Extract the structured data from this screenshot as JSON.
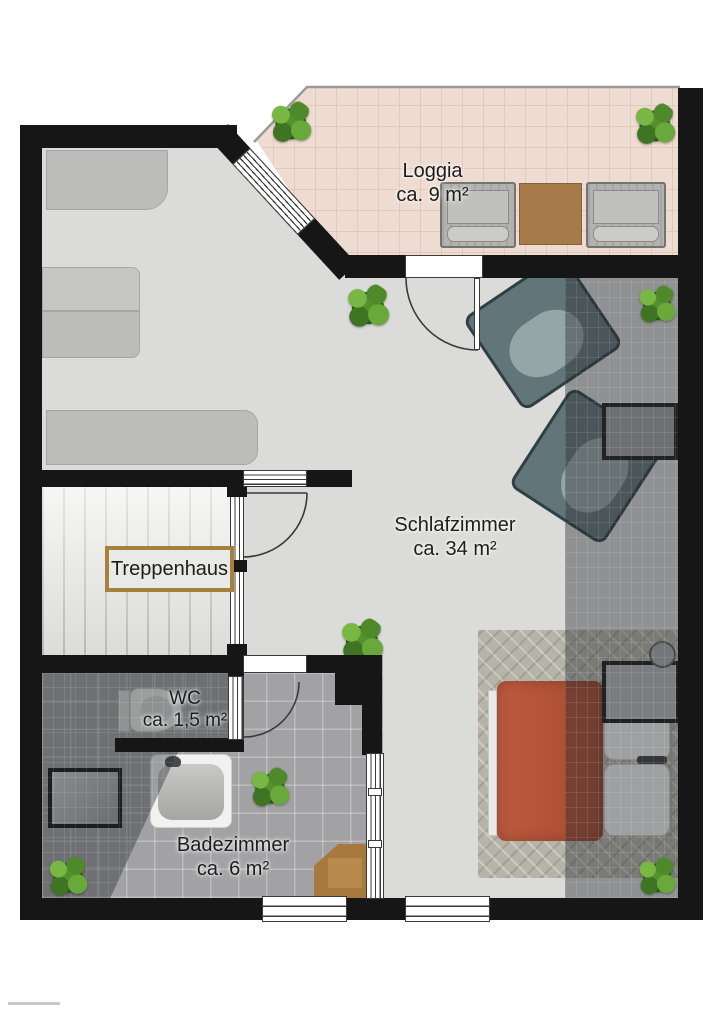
{
  "plan": {
    "type": "floor-plan",
    "rooms": {
      "loggia": {
        "name": "Loggia",
        "area": "ca. 9 m²"
      },
      "schlafzimmer": {
        "name": "Schlafzimmer",
        "area": "ca. 34 m²"
      },
      "treppenhaus": {
        "name": "Treppenhaus"
      },
      "wc": {
        "name": "WC",
        "area": "ca. 1,5 m²"
      },
      "badezimmer": {
        "name": "Badezimmer",
        "area": "ca. 6 m²"
      }
    },
    "colors": {
      "wall": "#161616",
      "bedroom_floor": "#dbdbd9",
      "loggia_floor": "#eedbd1",
      "bath_tile": "#a2a2a4",
      "stair_floor": "#ececea",
      "label_box_border": "#a5813c",
      "bed_cover": "#b5543a",
      "bench_wood": "#a8793f",
      "armchair": "#627578",
      "plant_green": "#5d9434"
    },
    "furniture": [
      "wardrobe",
      "daybed",
      "sideboard",
      "armchair",
      "armchair",
      "side-table",
      "bed",
      "nightstand",
      "table-lamp",
      "herringbone-rug",
      "loggia-armchair",
      "loggia-armchair",
      "loggia-table",
      "toilet",
      "shower",
      "bathtub",
      "wooden-bench",
      "potted-plants-x8"
    ]
  }
}
